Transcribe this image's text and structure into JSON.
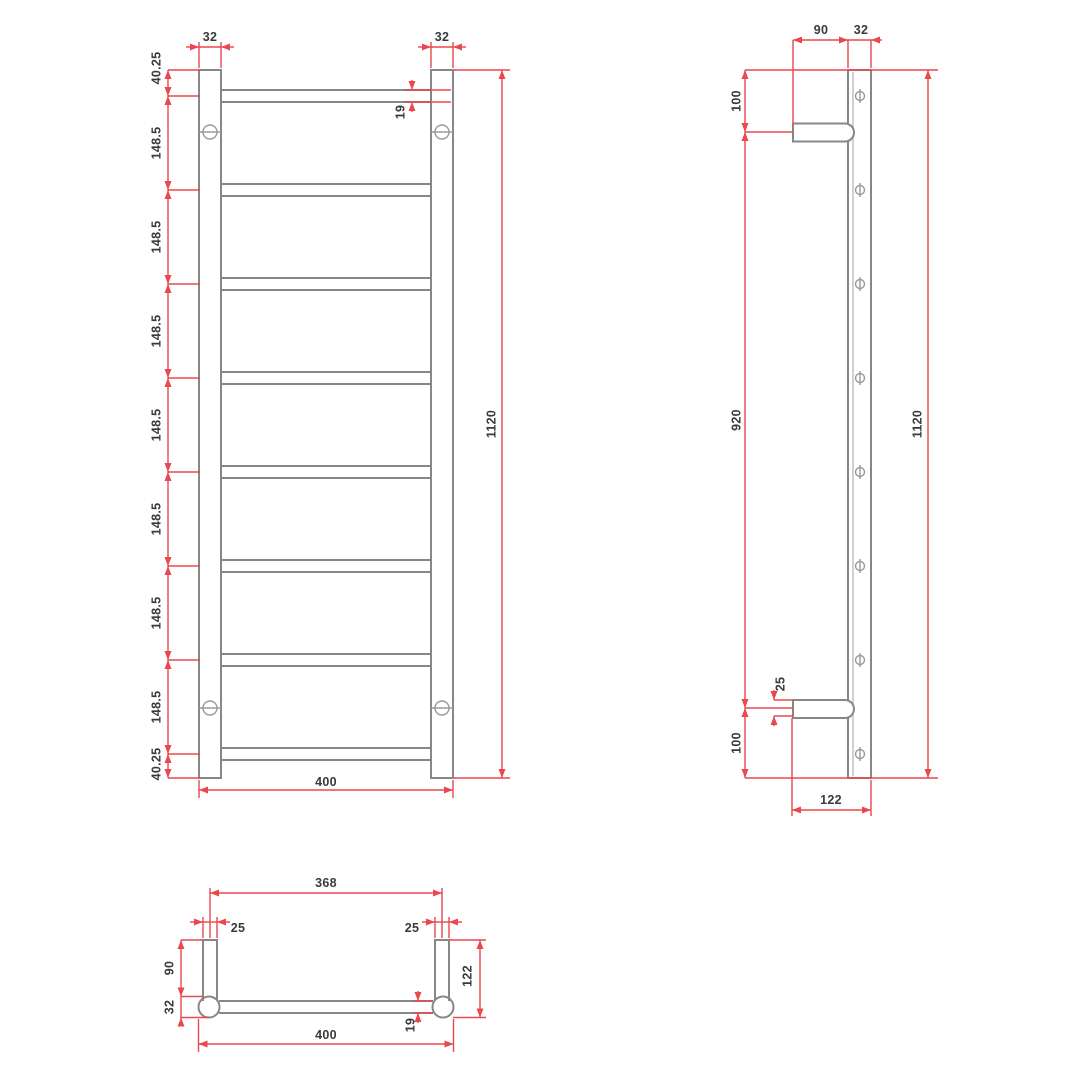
{
  "drawing": {
    "type": "heated-towel-ladder-technical-drawing",
    "colors": {
      "dimension_red": "#e8484e",
      "geometry_grey": "#878787",
      "label_grey": "#3a3a3a",
      "background": "#ffffff"
    },
    "front": {
      "post_width_left": "32",
      "post_width_right": "32",
      "chain": [
        "40.25",
        "148.5",
        "148.5",
        "148.5",
        "148.5",
        "148.5",
        "148.5",
        "148.5",
        "40.25"
      ],
      "tube_dia": "19",
      "overall_height": "1120",
      "overall_width": "400"
    },
    "side": {
      "bracket_length": "90",
      "post_depth": "32",
      "top_offset": "100",
      "bracket_spacing": "920",
      "bottom_offset": "100",
      "bracket_thickness": "25",
      "overall_height": "1120",
      "overall_depth": "122"
    },
    "plan": {
      "bracket_centres": "368",
      "bracket_width_left": "25",
      "bracket_width_right": "25",
      "bracket_length": "90",
      "post_dia": "32",
      "overall_depth": "122",
      "tube_dia": "19",
      "overall_width": "400"
    }
  }
}
